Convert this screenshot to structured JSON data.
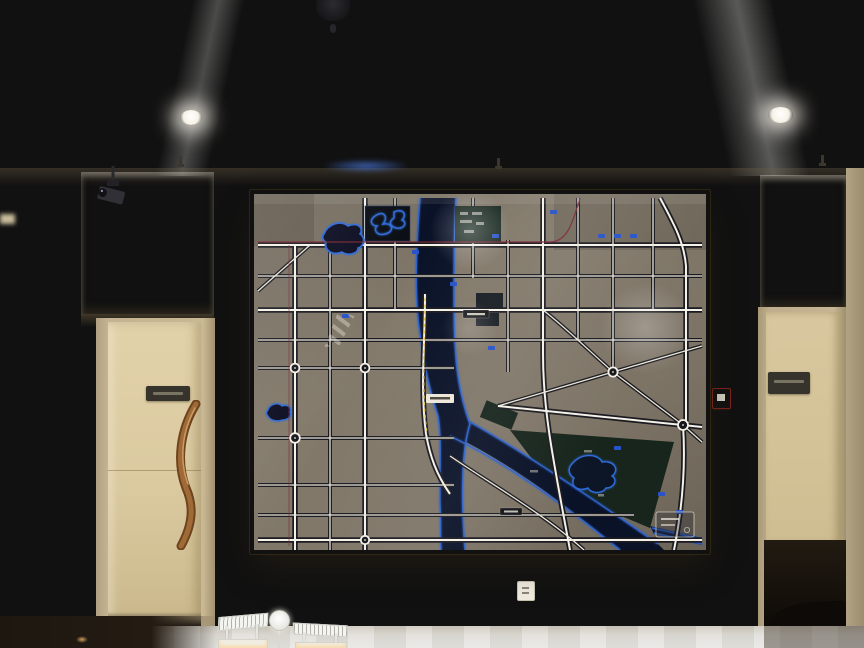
{
  "scene": {
    "description": "Lobby wall with a large back-lit city master-plan map in a gold frame, flanked by textured stone alcoves and doors",
    "text_legible": false
  },
  "watermark": {
    "text": "野模型",
    "logo": "diagonal-stripe-chevron"
  },
  "map": {
    "title_visible": "",
    "has_legend_box": "yes",
    "features": {
      "river": "vertical river forking into southeast branch",
      "lakes": "3 outlined lakes and 1 dark feature panel",
      "park": "dark green park with lake at lower right",
      "rail_line": "dark red line crossing upper map",
      "highlight_route": "yellow dashed road along river west bank"
    }
  },
  "colors": {
    "ceiling": "#e7e4dc",
    "wall": "#cbbc9e",
    "pillar": "#d3c5a7",
    "stone": "#c2b293",
    "door": "#dbcaa0",
    "dark_opening": "#14100b",
    "gold": "#dcbe72",
    "map_bg": "#7d7466",
    "road_white": "#f2efe6",
    "road_casing": "#1a1a20",
    "river_fill": "#0a1228",
    "river_edge": "#2e63cf",
    "park": "#17251c",
    "panel_dark": "#0a0e14",
    "rail": "#7c2733",
    "route_dash": "#e9c64f",
    "shield": "#2853c9",
    "label": "#efeadf",
    "alarm": "#b5372c",
    "handle_wood": "#8a5a33"
  }
}
